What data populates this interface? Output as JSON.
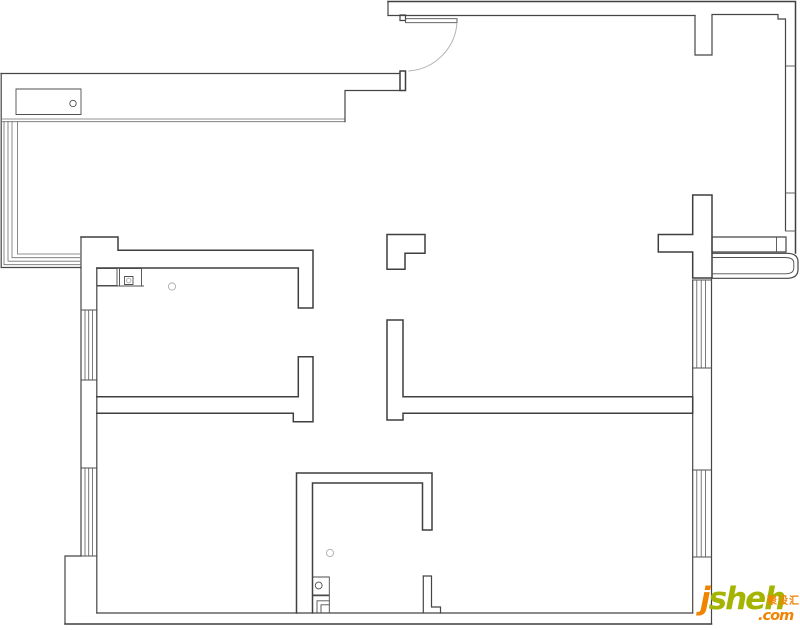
{
  "meta": {
    "canvas_width": 800,
    "canvas_height": 630,
    "background": "#ffffff",
    "line_color": "#3f3f3f",
    "light_line_color": "#b3b3b3",
    "description": "apartment floor plan line drawing"
  },
  "watermark": {
    "j": "j",
    "sheh": "sheh",
    "com": ".com",
    "cn": "聚设汇",
    "orange": "#f08300",
    "green": "#a4b400"
  },
  "floorplan": {
    "paths": [
      {
        "n": "north-balcony-top-edge",
        "c": "wall2",
        "d": "M1,73.5 H400"
      },
      {
        "n": "west-balcony-outer-edge",
        "c": "wall2",
        "d": "M1.2,73.5 V267.5 H81"
      },
      {
        "n": "balcony-sink-counter",
        "c": "thin",
        "d": "M16,89 H81 V114.5 H16 Z"
      },
      {
        "n": "north-balcony-rail-line",
        "c": "rail",
        "d": "M1,119 H345"
      },
      {
        "n": "north-balcony-rail-line",
        "c": "rail",
        "d": "M1,121.7 H345"
      },
      {
        "n": "north-wall-step",
        "c": "wall2",
        "d": "M345,121.7 V90.5 H400"
      },
      {
        "n": "entry-wall-end-cap",
        "c": "wall",
        "d": "M400,71 H405.5 V90.5 H400 Z"
      },
      {
        "n": "entry-door-hinge",
        "c": "wall2",
        "d": "M400,15 H405.5 V20.5 H400 Z"
      },
      {
        "n": "entry-door-leaf",
        "c": "thin",
        "d": "M405.5,18.7 H457 V22.7 H405.5 Z"
      },
      {
        "n": "entry-door-swing-arc",
        "c": "light",
        "d": "M457,22.7 A52,52 0 0 1 408.5,71"
      },
      {
        "n": "northeast-outer-wall",
        "c": "wall",
        "d": "M388,1.5 H795.5 V253"
      },
      {
        "n": "northeast-wall-left-cap",
        "c": "wall2",
        "d": "M388,1.5 V15.5"
      },
      {
        "n": "northeast-wall-inner-edge",
        "c": "wall2",
        "d": "M388,15.5 H695"
      },
      {
        "n": "northeast-wall-pier",
        "c": "wall2",
        "d": "M695,15.5 V55 H712 V15.5"
      },
      {
        "n": "east-wall-inner-edge",
        "c": "wall2",
        "d": "M712,14.5 H778 V19 H785.5 V230"
      },
      {
        "n": "east-wall-tick",
        "c": "thin",
        "d": "M785.5,66 H795.5"
      },
      {
        "n": "east-wall-tick",
        "c": "thin",
        "d": "M785.5,193 H795.5"
      },
      {
        "n": "east-wall-tick",
        "c": "thin",
        "d": "M785.5,231 H795.5"
      },
      {
        "n": "east-sill-wall",
        "c": "wall2",
        "d": "M712,237 H786 V252 H712 Z"
      },
      {
        "n": "east-sill-divider",
        "c": "thin",
        "d": "M776.5,237 V252"
      },
      {
        "n": "cross-wall-junction",
        "c": "wall",
        "d": "M692.7,195 H712 V278 H692.7 V252 H658.3 V234.5 H692.7 Z"
      },
      {
        "n": "east-bay-rail-outer",
        "c": "wall2",
        "d": "M712,253.3 H787 Q798,253.3 798,262 V269.5 Q798,278.3 787,278.3 H712"
      },
      {
        "n": "east-bay-rail-inner",
        "c": "thin",
        "d": "M712,257.5 H785 Q793.8,257.5 793.8,263 V268 Q793.8,273.8 785,273.8 H712"
      },
      {
        "n": "east-wall-inner-face",
        "c": "wall2",
        "d": "M692.7,280 V613"
      },
      {
        "n": "east-wall-outer-face",
        "c": "wall2",
        "d": "M711.5,278.3 V624"
      },
      {
        "n": "east-window-cap",
        "c": "thin",
        "d": "M692.7,280 H711.5"
      },
      {
        "n": "east-window-cap",
        "c": "thin",
        "d": "M692.7,368 H711.5"
      },
      {
        "n": "east-window-cap",
        "c": "thin",
        "d": "M692.7,470 H711.5"
      },
      {
        "n": "east-window-cap",
        "c": "thin",
        "d": "M692.7,557 H711.5"
      },
      {
        "n": "east-window-hatch",
        "c": "hatch",
        "d": "M696.8,280 V368"
      },
      {
        "n": "east-window-hatch",
        "c": "hatch",
        "d": "M701.2,280 V368"
      },
      {
        "n": "east-window-hatch",
        "c": "hatch",
        "d": "M705.6,280 V368"
      },
      {
        "n": "east-window-hatch",
        "c": "hatch",
        "d": "M696.8,470 V557"
      },
      {
        "n": "east-window-hatch",
        "c": "hatch",
        "d": "M701.2,470 V557"
      },
      {
        "n": "east-window-hatch",
        "c": "hatch",
        "d": "M705.6,470 V557"
      },
      {
        "n": "hall-corner-pillar",
        "c": "wall",
        "d": "M387,234.5 H425 V253.3 H405 V269.3 H387 Z"
      },
      {
        "n": "hall-tee-wall",
        "c": "wall",
        "d": "M387,320 H403 V396.8 H692.7 V413.3 H403 V420 H387 Z"
      },
      {
        "n": "bathroom-walls",
        "c": "wall",
        "d": "M296.5,613 V473 H432 V530 H422.5 V483 H312.5 V613"
      },
      {
        "n": "bathroom-door-pillar",
        "c": "wall2",
        "d": "M423.3,576 H431.5 V607 H440.5 V613"
      },
      {
        "n": "bathroom-door-pillar-face",
        "c": "wall2",
        "d": "M423.3,576 V613"
      },
      {
        "n": "bedroom1-north-wall",
        "c": "wall",
        "d": "M81,237 H118 V250.3 H313 V308 H298.3 V268 H96.8"
      },
      {
        "n": "west-wall-outer-face",
        "c": "wall2",
        "d": "M81,237 V556"
      },
      {
        "n": "west-wall-jut",
        "c": "wall2",
        "d": "M81,556 H65 V624"
      },
      {
        "n": "west-wall-inner-face",
        "c": "wall2",
        "d": "M96.8,268 V613"
      },
      {
        "n": "west-window-cap",
        "c": "thin",
        "d": "M81,310 H96.8"
      },
      {
        "n": "west-window-cap",
        "c": "thin",
        "d": "M81,380 H96.8"
      },
      {
        "n": "west-window-cap",
        "c": "thin",
        "d": "M81,468 H96.8"
      },
      {
        "n": "west-window-cap",
        "c": "thin",
        "d": "M81,556 H96.8"
      },
      {
        "n": "west-window-hatch",
        "c": "hatch",
        "d": "M85,310 V380"
      },
      {
        "n": "west-window-hatch",
        "c": "hatch",
        "d": "M88.7,310 V380"
      },
      {
        "n": "west-window-hatch",
        "c": "hatch",
        "d": "M92.4,310 V380"
      },
      {
        "n": "west-window-hatch",
        "c": "hatch",
        "d": "M85,468 V556"
      },
      {
        "n": "west-window-hatch",
        "c": "hatch",
        "d": "M88.7,468 V556"
      },
      {
        "n": "west-window-hatch",
        "c": "hatch",
        "d": "M92.4,468 V556"
      },
      {
        "n": "bedroom2-north-wall",
        "c": "wall",
        "d": "M96.8,396.8 H298.3 V356.8 H313 V421.7 H293.3 V413.3 H96.8"
      },
      {
        "n": "south-wall-inner-edge",
        "c": "wall2",
        "d": "M96.8,613 H692.7"
      },
      {
        "n": "south-wall-outer-edge",
        "c": "wall",
        "d": "M65,624 H711.5"
      },
      {
        "n": "west-balcony-rail",
        "c": "rail",
        "d": "M17.5,121.7 V254 H81"
      },
      {
        "n": "west-balcony-rail",
        "c": "rail",
        "d": "M12,121.7 V257.7 H81"
      },
      {
        "n": "west-balcony-rail",
        "c": "rail",
        "d": "M8,121.7 V261.2 H81"
      },
      {
        "n": "west-balcony-rail",
        "c": "rail",
        "d": "M4,121.7 V264.7 H81"
      },
      {
        "n": "bedroom1-cabinet",
        "c": "fix",
        "d": "M96.8,268.5 H117 V285.5 H96.8 Z"
      },
      {
        "n": "bedroom1-cabinet",
        "c": "fix",
        "d": "M119.5,268.5 H141.5 V286 H119.5 Z"
      },
      {
        "n": "bedroom1-cabinet-front",
        "c": "thin",
        "d": "M96.8,286 H143.5"
      },
      {
        "n": "bedroom1-cabinet-flap",
        "c": "thin",
        "d": "M124.5,276.5 H133 V284.5 H124.5 Z"
      },
      {
        "n": "bathroom-fixture-box",
        "c": "fix",
        "d": "M312.5,577 H329.3 V595 H312.5"
      },
      {
        "n": "bathroom-fixture-box",
        "c": "fix",
        "d": "M312.5,595.8 H329.3 V613 H312.5"
      },
      {
        "n": "bathroom-fixture-corner",
        "c": "thin",
        "d": "M317,613 V600.8 H329.3"
      },
      {
        "n": "bathroom-fixture-corner",
        "c": "thin",
        "d": "M321,613 V604.8 H329.3"
      }
    ],
    "circles": [
      {
        "n": "balcony-sink-drain",
        "c": "thin",
        "cx": 73,
        "cy": 103.5,
        "r": 3.2
      },
      {
        "n": "bedroom1-ceiling-lamp",
        "c": "light",
        "cx": 172,
        "cy": 286.5,
        "r": 3.6
      },
      {
        "n": "bedroom1-cabinet-knob",
        "c": "light",
        "cx": 128.7,
        "cy": 280.5,
        "r": 2.2
      },
      {
        "n": "bathroom-floor-drain",
        "c": "light",
        "cx": 330,
        "cy": 553,
        "r": 3.6
      },
      {
        "n": "bathroom-fixture-drain",
        "c": "thin",
        "cx": 318.7,
        "cy": 585.5,
        "r": 3.4
      }
    ]
  }
}
